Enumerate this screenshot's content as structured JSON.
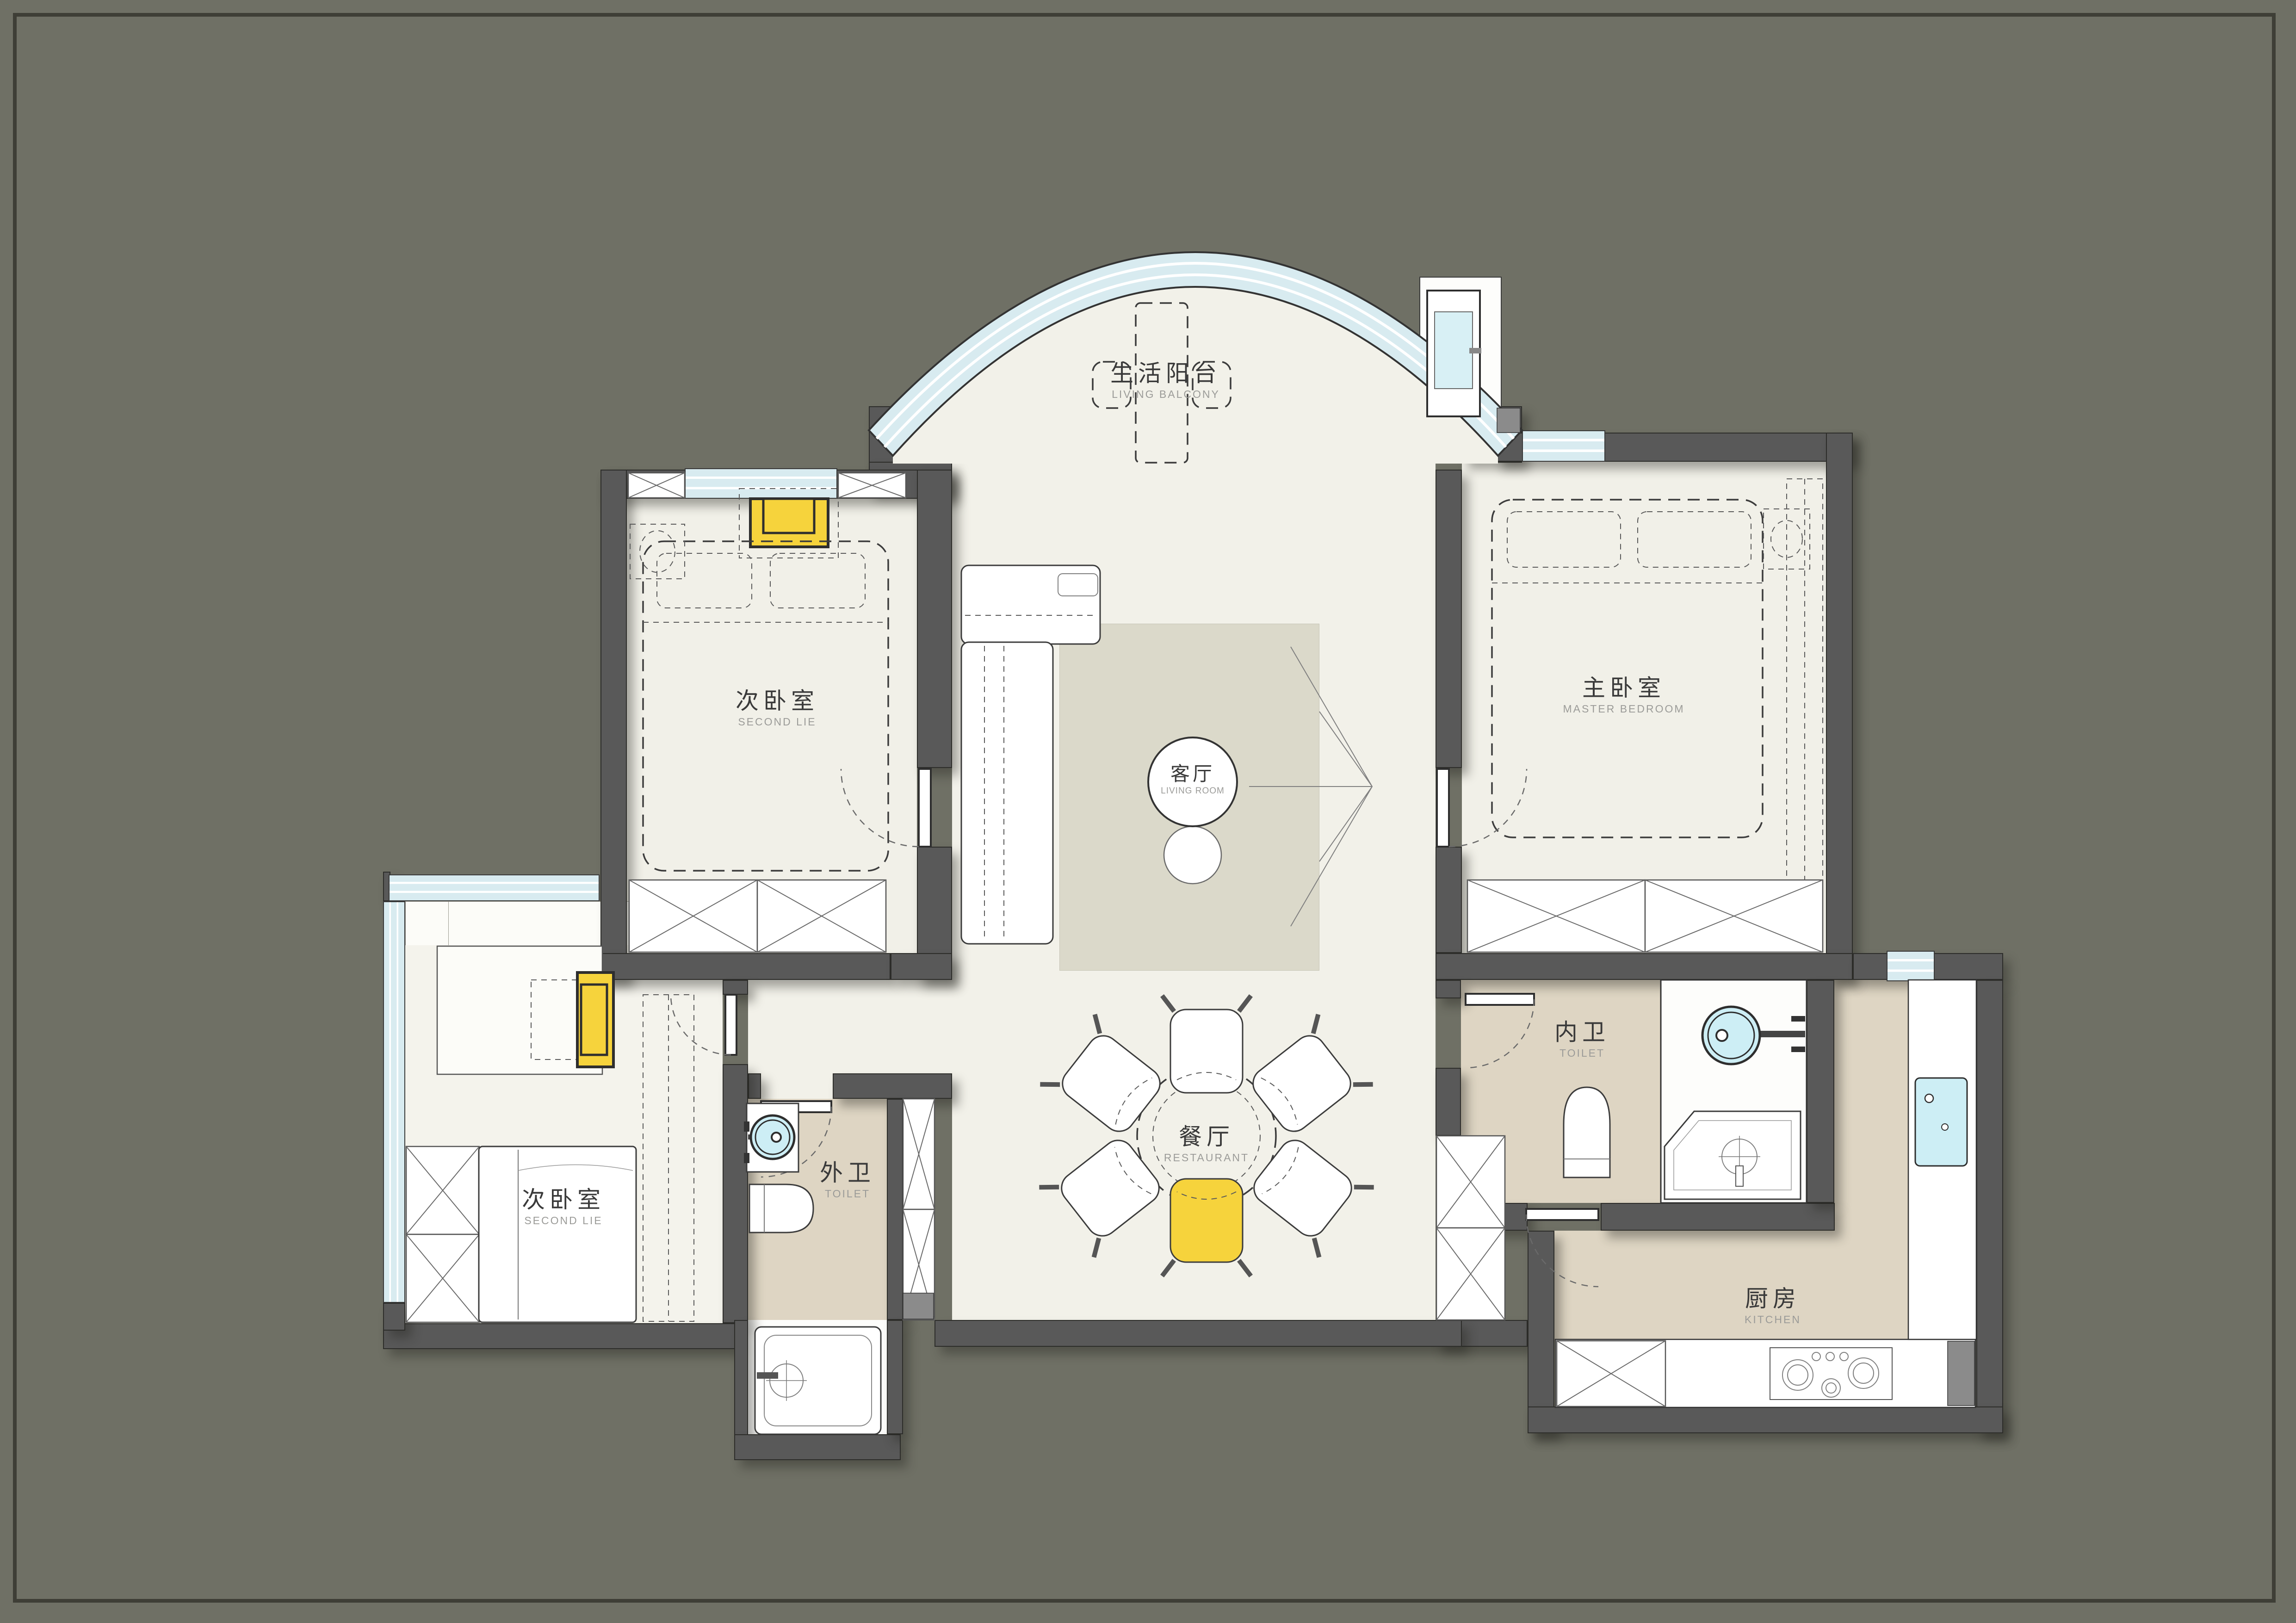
{
  "palette": {
    "background": "#6F7065",
    "wall": "#595959",
    "floor_light": "#F2F1E9",
    "floor_warm": "#DED5C3",
    "rug": "#DBD9CA",
    "window_glass": "#D8EBF0",
    "accent_yellow": "#F6D33C",
    "basin_cyan": "#CDEEF5",
    "label_cn": "#3A3A3A",
    "label_en": "#9B9B98"
  },
  "rooms": [
    {
      "id": "living-balcony",
      "zh": "生活阳台",
      "en": "LIVING BALCONY"
    },
    {
      "id": "second-bedroom-upper",
      "zh": "次卧室",
      "en": "SECOND LIE"
    },
    {
      "id": "master-bedroom",
      "zh": "主卧室",
      "en": "MASTER BEDROOM"
    },
    {
      "id": "living-room",
      "zh": "客厅",
      "en": "LIVING ROOM"
    },
    {
      "id": "dining-room",
      "zh": "餐厅",
      "en": "RESTAURANT"
    },
    {
      "id": "inner-toilet",
      "zh": "内卫",
      "en": "TOILET"
    },
    {
      "id": "outer-toilet",
      "zh": "外卫",
      "en": "TOILET"
    },
    {
      "id": "second-bedroom-lower",
      "zh": "次卧室",
      "en": "SECOND LIE"
    },
    {
      "id": "kitchen",
      "zh": "厨房",
      "en": "KITCHEN"
    }
  ]
}
